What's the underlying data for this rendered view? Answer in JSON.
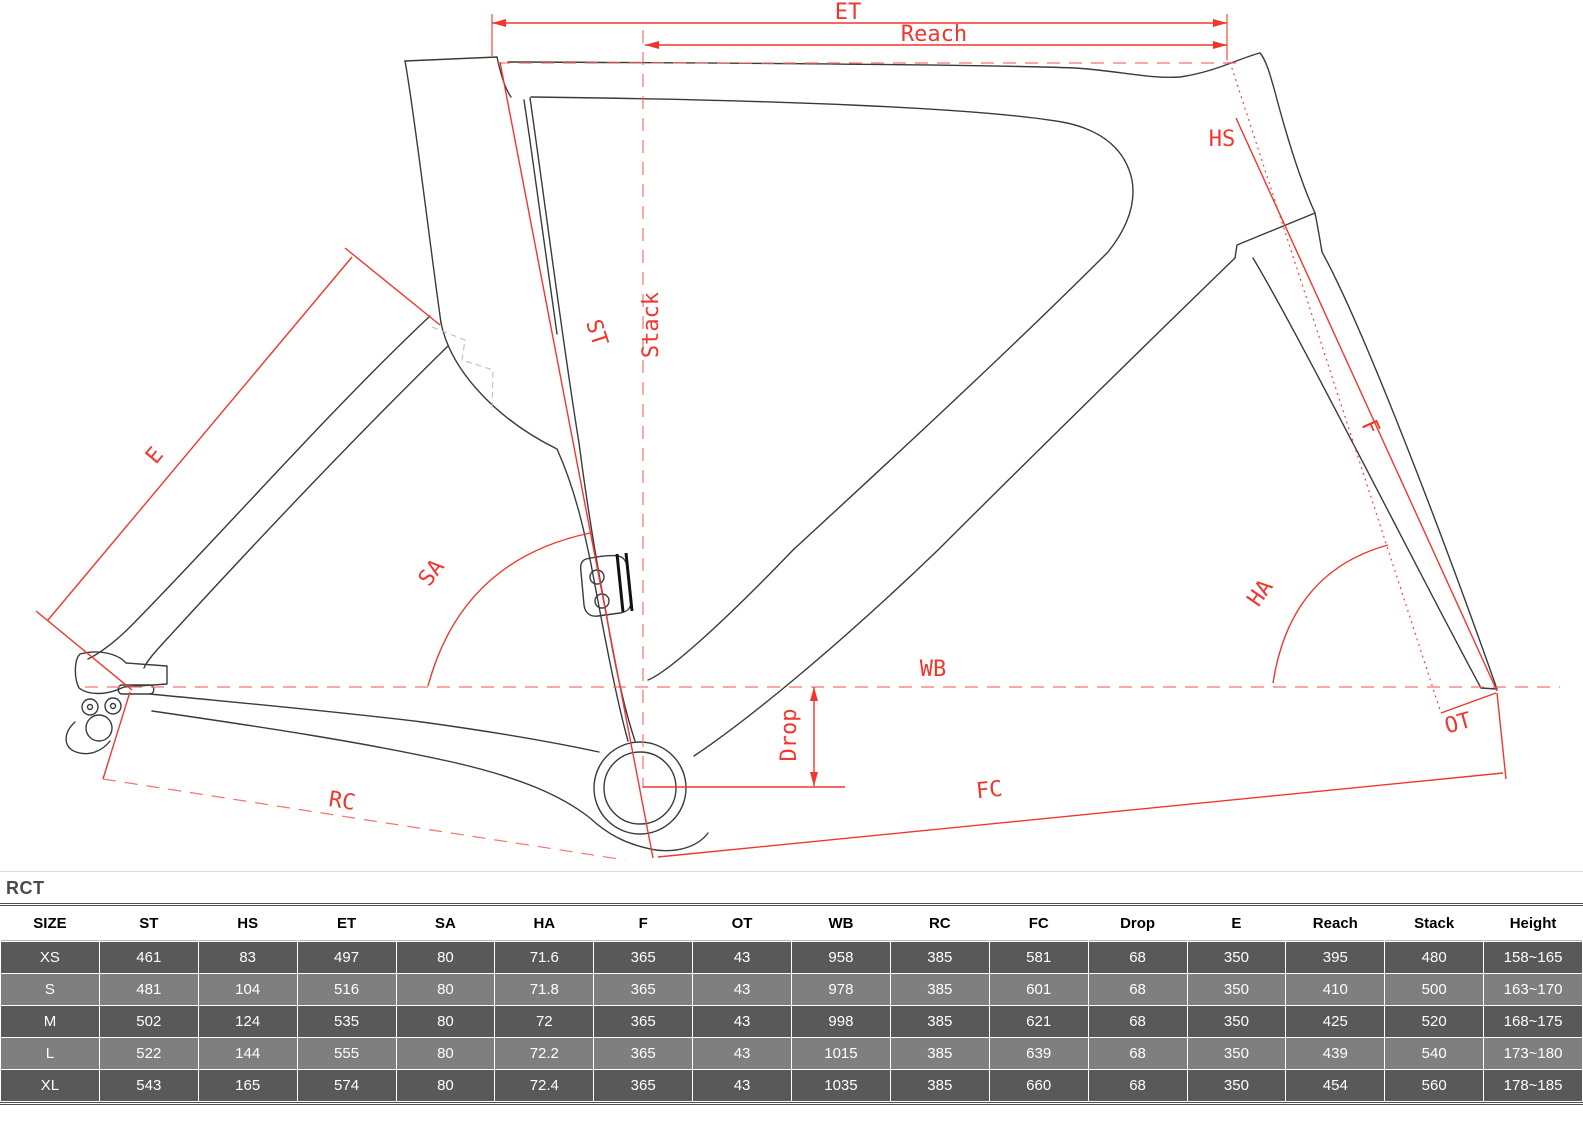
{
  "diagram": {
    "labels": {
      "et": "ET",
      "reach": "Reach",
      "hs": "HS",
      "st": "ST",
      "stack": "Stack",
      "e": "E",
      "sa": "SA",
      "f": "F",
      "ha": "HA",
      "wb": "WB",
      "drop": "Drop",
      "ot": "OT",
      "rc": "RC",
      "fc": "FC"
    },
    "colors": {
      "annotation_red": "#f2362e",
      "outline_black": "#3a3a3a"
    }
  },
  "table": {
    "title": "RCT",
    "columns": [
      "SIZE",
      "ST",
      "HS",
      "ET",
      "SA",
      "HA",
      "F",
      "OT",
      "WB",
      "RC",
      "FC",
      "Drop",
      "E",
      "Reach",
      "Stack",
      "Height"
    ],
    "rows": [
      [
        "XS",
        "461",
        "83",
        "497",
        "80",
        "71.6",
        "365",
        "43",
        "958",
        "385",
        "581",
        "68",
        "350",
        "395",
        "480",
        "158~165"
      ],
      [
        "S",
        "481",
        "104",
        "516",
        "80",
        "71.8",
        "365",
        "43",
        "978",
        "385",
        "601",
        "68",
        "350",
        "410",
        "500",
        "163~170"
      ],
      [
        "M",
        "502",
        "124",
        "535",
        "80",
        "72",
        "365",
        "43",
        "998",
        "385",
        "621",
        "68",
        "350",
        "425",
        "520",
        "168~175"
      ],
      [
        "L",
        "522",
        "144",
        "555",
        "80",
        "72.2",
        "365",
        "43",
        "1015",
        "385",
        "639",
        "68",
        "350",
        "439",
        "540",
        "173~180"
      ],
      [
        "XL",
        "543",
        "165",
        "574",
        "80",
        "72.4",
        "365",
        "43",
        "1035",
        "385",
        "660",
        "68",
        "350",
        "454",
        "560",
        "178~185"
      ]
    ],
    "style": {
      "row_dark": "#595959",
      "row_light": "#7f7f7f",
      "header_text": "#000000",
      "cell_text": "#ffffff"
    }
  }
}
